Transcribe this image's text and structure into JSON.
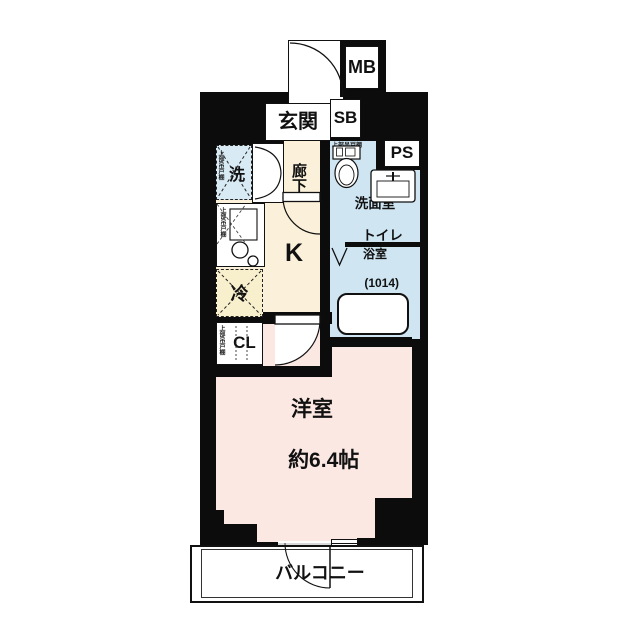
{
  "floorplan": {
    "rooms": {
      "genkan": "玄関",
      "hallway": "廊下",
      "kitchen": "K",
      "washroom_l1": "洗面室",
      "washroom_l2": "トイレ",
      "bath_l1": "浴室",
      "bath_l2": "(1014)",
      "main_room_l1": "洋室",
      "main_room_l2": "約6.4帖",
      "balcony": "バルコニー"
    },
    "fixtures": {
      "meter_box": "MB",
      "shoe_box": "SB",
      "pipe_space": "PS",
      "washer": "洗",
      "fridge": "冷",
      "closet": "CL",
      "upper_cabinet": "上部吊戸棚"
    },
    "colors": {
      "wall": "#0c0c0c",
      "wet_area": "#cfe5f2",
      "washer_area": "#d8ebf5",
      "kitchen_hall": "#fbf1da",
      "fridge_area": "#f8efcd",
      "main_room": "#fce8e3",
      "background": "#ffffff"
    }
  }
}
